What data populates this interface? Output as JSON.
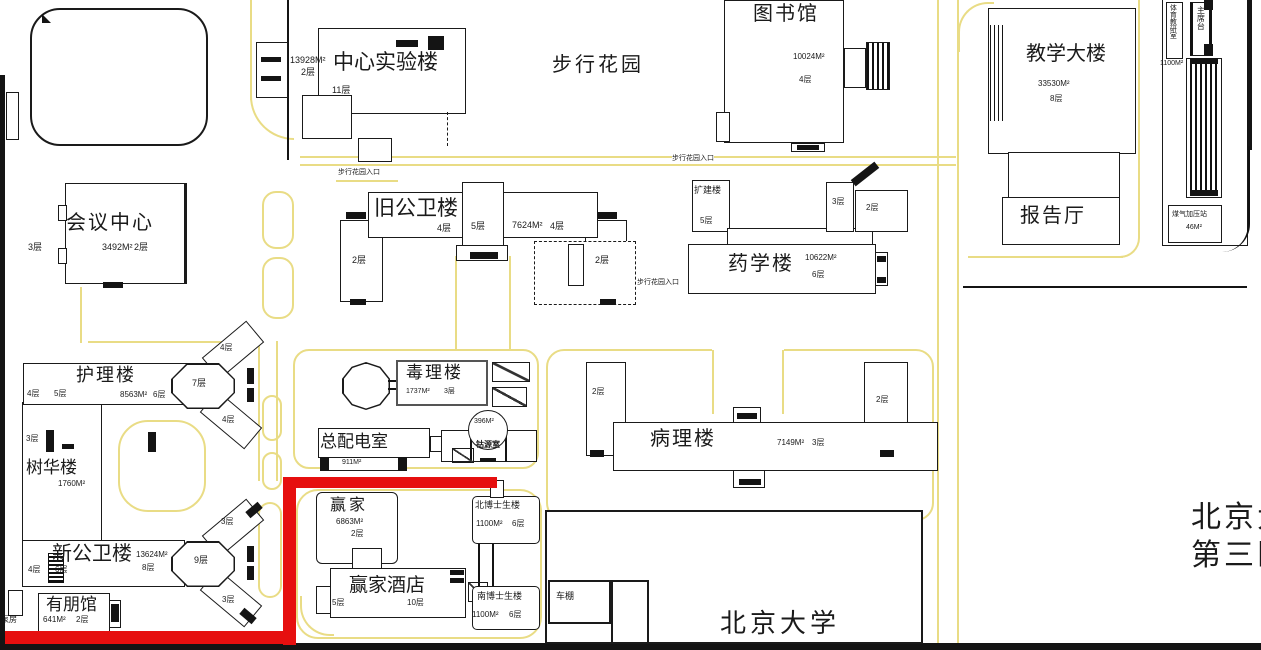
{
  "map_title": "campus site plan",
  "colors": {
    "road": "#e9dc85",
    "highlight": "#e60f0f",
    "outline": "#1a1a1a"
  },
  "b": {
    "central_lab": {
      "name": "中心实验楼",
      "floors": "11层",
      "annex_area": "13928M²",
      "annex_floors": "2层"
    },
    "garden": {
      "name": "步行花园"
    },
    "garden_entrance": {
      "label": "步行花园入口"
    },
    "library": {
      "name": "图书馆",
      "area": "10024M²",
      "floors": "4层"
    },
    "conference": {
      "name": "会议中心",
      "left_floors": "3层",
      "area": "3492M²",
      "floors": "2层"
    },
    "old_ph": {
      "name": "旧公卫楼",
      "f1": "4层",
      "f2": "5层",
      "area": "7624M²",
      "f3": "4层",
      "wing_left": "2层",
      "wing_right": "2层"
    },
    "pharmacy": {
      "name": "药学楼",
      "area": "10622M²",
      "floors": "6层",
      "annex": "扩建楼",
      "annex_floors": "5层",
      "small1": "3层",
      "small2": "2层"
    },
    "teaching": {
      "name": "教学大楼",
      "area": "33530M²",
      "floors": "8层"
    },
    "hall": {
      "name": "报告厅"
    },
    "pe": {
      "name": "体育教研室"
    },
    "rostrum": {
      "name": "主席台"
    },
    "stand": {
      "area": "1100M²"
    },
    "gas": {
      "name": "煤气加压站",
      "area": "46M²"
    },
    "nursing": {
      "name": "护理楼",
      "f1": "4层",
      "f2": "5层",
      "area": "8563M²",
      "f3": "6层",
      "y_center": "7层",
      "y_top": "4层",
      "y_bottom": "4层"
    },
    "shuhua": {
      "name": "树华楼",
      "floors": "3层",
      "area": "1760M²"
    },
    "toxicology": {
      "name": "毒理楼",
      "area": "1737M²",
      "floors": "3层"
    },
    "power": {
      "name": "总配电室",
      "area": "911M²"
    },
    "cobalt": {
      "name": "钴源室",
      "area": "396M²"
    },
    "pathology": {
      "name": "病理楼",
      "area": "7149M²",
      "floors": "3层",
      "wing_left": "2层",
      "wing_right": "2层"
    },
    "new_ph": {
      "name": "新公卫楼",
      "area": "13624M²",
      "floors": "8层",
      "f1": "4层",
      "f2": "6层",
      "y_center": "9层",
      "y_top": "3层",
      "y_bottom": "3层"
    },
    "youpeng": {
      "name": "有朋馆",
      "area": "641M²",
      "floors": "2层"
    },
    "pump": {
      "name": "泵房"
    },
    "winner": {
      "name": "赢家",
      "area": "6863M²",
      "floors": "2层"
    },
    "winner_hotel": {
      "name": "赢家酒店",
      "floors": "10层",
      "wing_floors": "5层"
    },
    "dorm_n": {
      "name": "北博士生楼",
      "area": "1100M²",
      "floors": "6层"
    },
    "dorm_s": {
      "name": "南博士生楼",
      "area": "1100M²",
      "floors": "6层"
    },
    "shed": {
      "name": "车棚"
    },
    "pku": {
      "name": "北京大学"
    },
    "hospital": {
      "line1": "北京大",
      "line2": "第三医"
    }
  }
}
